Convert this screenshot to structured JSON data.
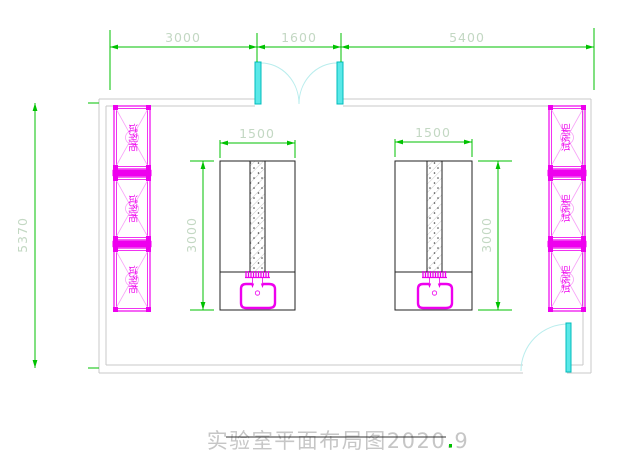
{
  "drawing": {
    "title": "实验室平面布局图2020.9"
  },
  "dimensions": {
    "top_segments": [
      "3000",
      "1600",
      "5400"
    ],
    "overall_height": "5370",
    "bench_width": "1500",
    "bench_depth": "3000"
  },
  "labels": {
    "reagent_cabinet": "试剂柜"
  },
  "colors": {
    "dimension_green": "#00c200",
    "dimension_text": "#c3d8c3",
    "fixture_magenta": "#ee00ee",
    "door_cyan": "#00e0e0",
    "wall_gray": "#c9c9c9",
    "title_gray": "#c6c6c6"
  }
}
